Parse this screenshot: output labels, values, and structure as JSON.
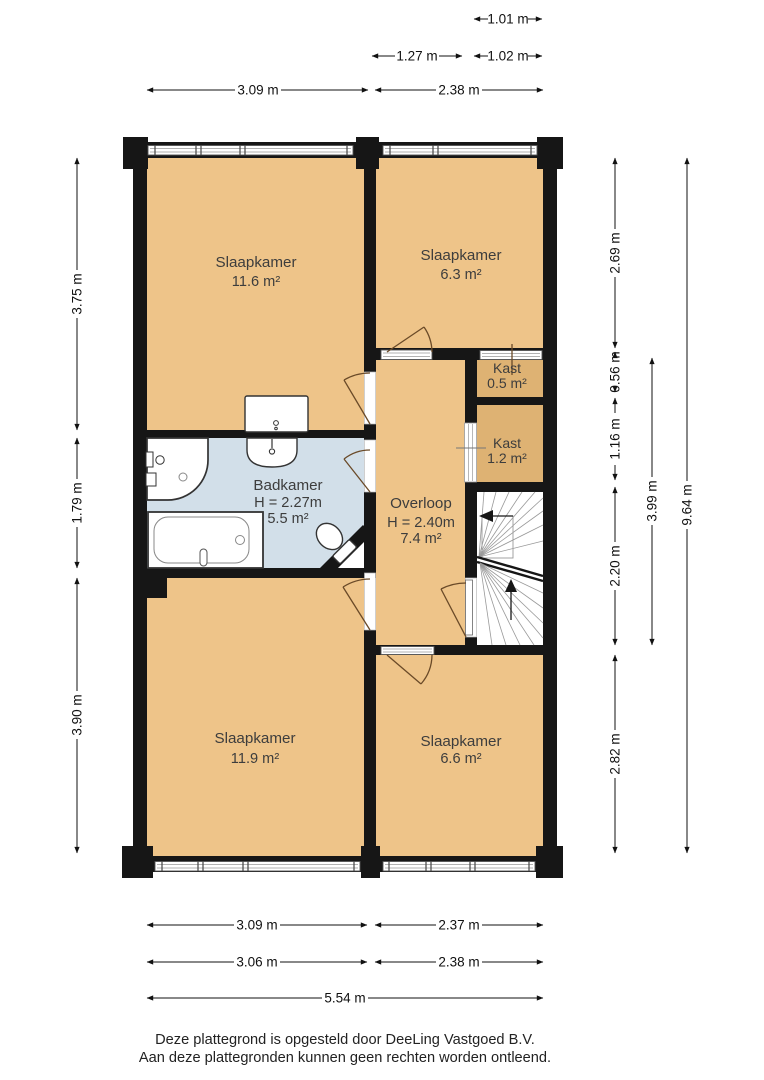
{
  "plan_title": "Verdieping plattegrond",
  "rooms": {
    "slaapkamer_tl": {
      "name": "Slaapkamer",
      "area": "11.6 m²"
    },
    "slaapkamer_tr": {
      "name": "Slaapkamer",
      "area": "6.3 m²"
    },
    "kast_klein": {
      "name": "Kast",
      "area": "0.5 m²"
    },
    "kast_groot": {
      "name": "Kast",
      "area": "1.2 m²"
    },
    "badkamer": {
      "name": "Badkamer",
      "ceiling": "H = 2.27m",
      "area": "5.5 m²"
    },
    "overloop": {
      "name": "Overloop",
      "ceiling": "H = 2.40m",
      "area": "7.4 m²"
    },
    "slaapkamer_bl": {
      "name": "Slaapkamer",
      "area": "11.9 m²"
    },
    "slaapkamer_br": {
      "name": "Slaapkamer",
      "area": "6.6 m²"
    }
  },
  "dims": {
    "top": [
      "1.01 m",
      "1.27 m",
      "1.02 m",
      "3.09 m",
      "2.38 m"
    ],
    "bottom": [
      "3.09 m",
      "2.37 m",
      "3.06 m",
      "2.38 m",
      "5.54 m"
    ],
    "left": [
      "3.75 m",
      "1.79 m",
      "3.90 m"
    ],
    "right": [
      "2.69 m",
      "0.56 m",
      "1.16 m",
      "2.20 m",
      "2.82 m",
      "3.99 m",
      "9.64 m"
    ]
  },
  "footer": {
    "line1": "Deze plattegrond is opgesteld door DeeLing Vastgoed B.V.",
    "line2": "Aan deze plattegronden kunnen geen rechten worden ontleend."
  },
  "colors": {
    "room_fill": "#eec489",
    "closet_fill": "#deb273",
    "bathroom_fill": "#d2dfe9",
    "wall": "#161616",
    "stairs_fill": "#ffffff"
  }
}
